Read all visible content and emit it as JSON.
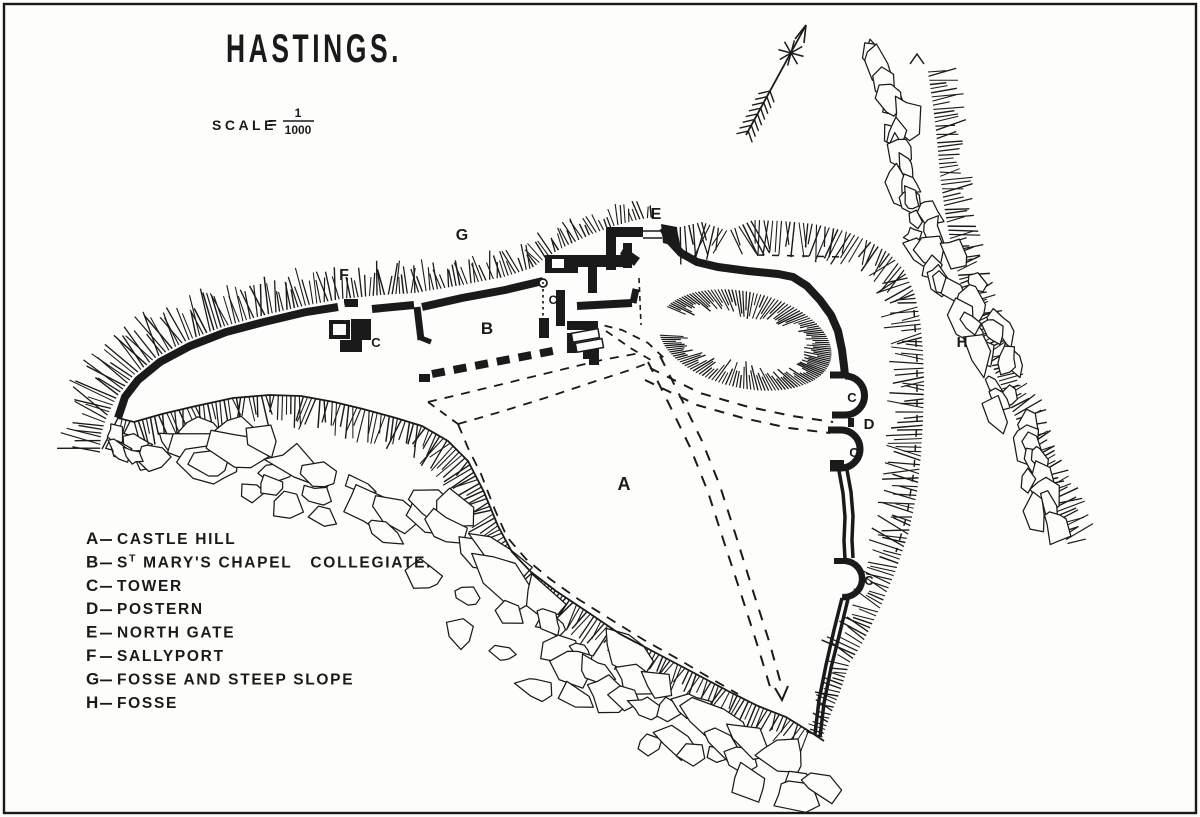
{
  "colors": {
    "paper": "#fdfdfb",
    "ink": "#1a1a1a"
  },
  "title": "HASTINGS.",
  "scale": {
    "label": "SCALE",
    "equals": "=",
    "numerator": "1",
    "denominator": "1000"
  },
  "north_arrow": {
    "icon": "north-arrow"
  },
  "legend": {
    "items": [
      {
        "letter": "A",
        "label": "CASTLE HILL"
      },
      {
        "letter": "B",
        "label": "",
        "parts": [
          {
            "t": "S"
          },
          {
            "t": "T",
            "sup": true
          },
          {
            "t": " MARY'S CHAPEL   COLLEGIATE."
          }
        ]
      },
      {
        "letter": "C",
        "label": "TOWER"
      },
      {
        "letter": "D",
        "label": "POSTERN"
      },
      {
        "letter": "E",
        "label": "NORTH GATE"
      },
      {
        "letter": "F",
        "label": "SALLYPORT"
      },
      {
        "letter": "G",
        "label": "FOSSE AND STEEP SLOPE"
      },
      {
        "letter": "H",
        "label": "FOSSE"
      }
    ]
  },
  "map_labels": [
    {
      "text": "G",
      "x": 462,
      "y": 240,
      "size": 16
    },
    {
      "text": "F",
      "x": 344,
      "y": 280,
      "size": 16
    },
    {
      "text": "E",
      "x": 656,
      "y": 219,
      "size": 16
    },
    {
      "text": "B",
      "x": 487,
      "y": 334,
      "size": 17
    },
    {
      "text": "C",
      "x": 553,
      "y": 304,
      "size": 12
    },
    {
      "text": "C",
      "x": 376,
      "y": 347,
      "size": 13
    },
    {
      "text": "C",
      "x": 852,
      "y": 402,
      "size": 13
    },
    {
      "text": "D",
      "x": 869,
      "y": 429,
      "size": 15
    },
    {
      "text": "C",
      "x": 854,
      "y": 457,
      "size": 13
    },
    {
      "text": "C",
      "x": 869,
      "y": 585,
      "size": 13
    },
    {
      "text": "A",
      "x": 624,
      "y": 490,
      "size": 18
    },
    {
      "text": "H",
      "x": 962,
      "y": 347,
      "size": 15
    }
  ]
}
